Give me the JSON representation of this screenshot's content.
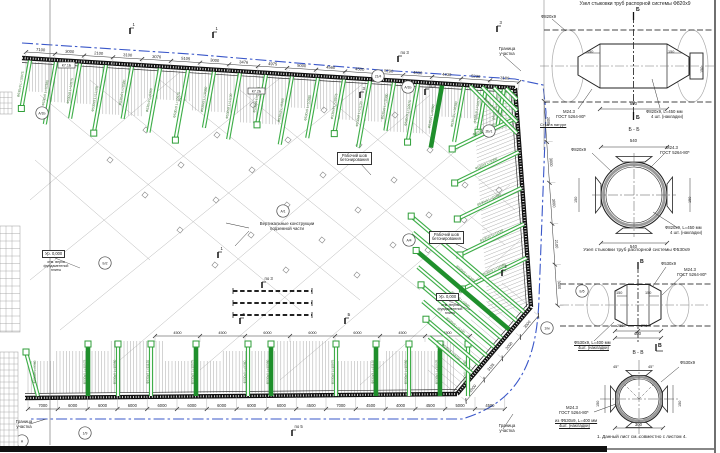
{
  "plan": {
    "labels": {
      "vertical_structures": "Вертикальные конструкции\nподземной части",
      "work_joint": "Рабочий шов\nбетонирования",
      "site_boundary": "Граница\nучастка",
      "level_mark": "Ур. 0,000",
      "level_sub": "отм. верха\nфундаментной плиты"
    },
    "top_dims": [
      "7100",
      "3000",
      "2100",
      "3100",
      "3076",
      "5105",
      "3000",
      "3476",
      "4975",
      "5000",
      "4560",
      "4500",
      "5290",
      "4530",
      "4430",
      "5230",
      "3180"
    ],
    "bottom_dims": [
      "7000",
      "6000",
      "6000",
      "6000",
      "6000",
      "6000",
      "6000",
      "6000",
      "6000",
      "4500",
      "7000",
      "4500",
      "4000",
      "4500",
      "5000",
      "4500"
    ],
    "right_dims": [
      "2085",
      "3000",
      "3000",
      "2100",
      "3000"
    ],
    "diag_dims": [
      "2000",
      "3135",
      "3000",
      "3000"
    ],
    "inner_dims": [
      "4500",
      "4500",
      "6000",
      "6000",
      "6000",
      "4500",
      "4500"
    ],
    "grid_bubbles": [
      {
        "x": 42,
        "y": 113,
        "label": "А/1Б"
      },
      {
        "x": 378,
        "y": 76,
        "label": "21/4"
      },
      {
        "x": 489,
        "y": 131,
        "label": "2Б/1"
      },
      {
        "x": 408,
        "y": 87,
        "label": "А/1Б"
      },
      {
        "x": 283,
        "y": 211,
        "label": "А/1"
      },
      {
        "x": 409,
        "y": 240,
        "label": "А/4"
      },
      {
        "x": 105,
        "y": 263,
        "label": "Б/2"
      },
      {
        "x": 547,
        "y": 328,
        "label": "1/м"
      },
      {
        "x": 85,
        "y": 433,
        "label": "1/9"
      },
      {
        "x": 582,
        "y": 291,
        "label": "Б/5"
      },
      {
        "x": 22,
        "y": 441,
        "label": "А"
      }
    ],
    "section_flags": [
      {
        "x": 130,
        "y": 26,
        "label": "1"
      },
      {
        "x": 213,
        "y": 30,
        "label": "1"
      },
      {
        "x": 398,
        "y": 54,
        "label": "по 3"
      },
      {
        "x": 497,
        "y": 24,
        "label": "3"
      },
      {
        "x": 360,
        "y": 90,
        "label": "3"
      },
      {
        "x": 425,
        "y": 87,
        "label": "по 3"
      },
      {
        "x": 218,
        "y": 250,
        "label": "1"
      },
      {
        "x": 262,
        "y": 280,
        "label": "по 3"
      },
      {
        "x": 502,
        "y": 268,
        "label": "2"
      },
      {
        "x": 240,
        "y": 316,
        "label": "Б"
      },
      {
        "x": 345,
        "y": 316,
        "label": "Б"
      },
      {
        "x": 292,
        "y": 428,
        "label": "по 5"
      }
    ],
    "tag_boxes": [
      {
        "x": 58,
        "y": 62,
        "label": "К7.1Б"
      },
      {
        "x": 248,
        "y": 88,
        "label": "К7.2Б"
      }
    ],
    "strut_type_530": "Ф530х9",
    "top_strut_lengths": [
      "L=10975",
      "L=10380",
      "L=10975",
      "L=11120",
      "L=10380",
      "L=9360",
      "L=10975",
      "L=10380",
      "L=11120",
      "L=10975",
      "L=9360",
      "L=10380",
      "L=10975",
      "L=11120",
      "L=10380",
      "L=10975",
      "L=9360",
      "L=10380"
    ],
    "right_struts": [
      {
        "y": 118,
        "label": "Ф820х9 L=4905"
      },
      {
        "y": 152,
        "label": "Ф530х9 L=9360"
      },
      {
        "y": 188,
        "label": "Ф530х9 L=10380"
      },
      {
        "y": 224,
        "label": "Ф530х9 L=11120"
      },
      {
        "y": 258,
        "label": "Ф530х9 L=11085"
      }
    ],
    "corner_strut_label": "Ф820х9 L=4905",
    "fan_labels": [
      "Ф530х9 L=6200",
      "Ф530х9 L=5800",
      "Ф530х9 L=5100",
      "Ф530х9 L=4750"
    ]
  },
  "details": {
    "d820": {
      "title": "Узел стыковки труб распорной системы Ф820х9",
      "pipe": "Ф820х9",
      "weld1": "М24.3",
      "weld2": "ГОСТ 5264-80*",
      "plate1": "Ф820х9, L=450 мм",
      "plate2": "4 шт. (накладки)",
      "joint_note": "Стык в натуре",
      "dim_500": "500",
      "dim_540": "540",
      "dim_150": "150",
      "letter": "Б",
      "caption": "Б - Б"
    },
    "d530": {
      "title": "Узел стыковки труб распорной системы Ф530х9",
      "pipe": "Ф530х9",
      "weld1": "М24.3",
      "weld2": "ГОСТ 5264-80*",
      "weld3": "из Ф530х9, L=400 мм",
      "weld4": "4шт. (накладки)",
      "plate1": "Ф530х9, L=400 мм",
      "plate2": "4шт. (накладки)",
      "dim_400": "400",
      "dim_250": "250",
      "dim_150": "150",
      "dim_300": "300",
      "angle": "45°",
      "letter": "В",
      "caption": "В - В"
    },
    "note": "1. Данный лист см. совместно с листом 4."
  },
  "colors": {
    "strut": "#3fae49",
    "strut_dark": "#1f8f2c",
    "boundary": "#3a57c9",
    "line": "#1c1c1c",
    "faint": "#b5b5b5"
  }
}
